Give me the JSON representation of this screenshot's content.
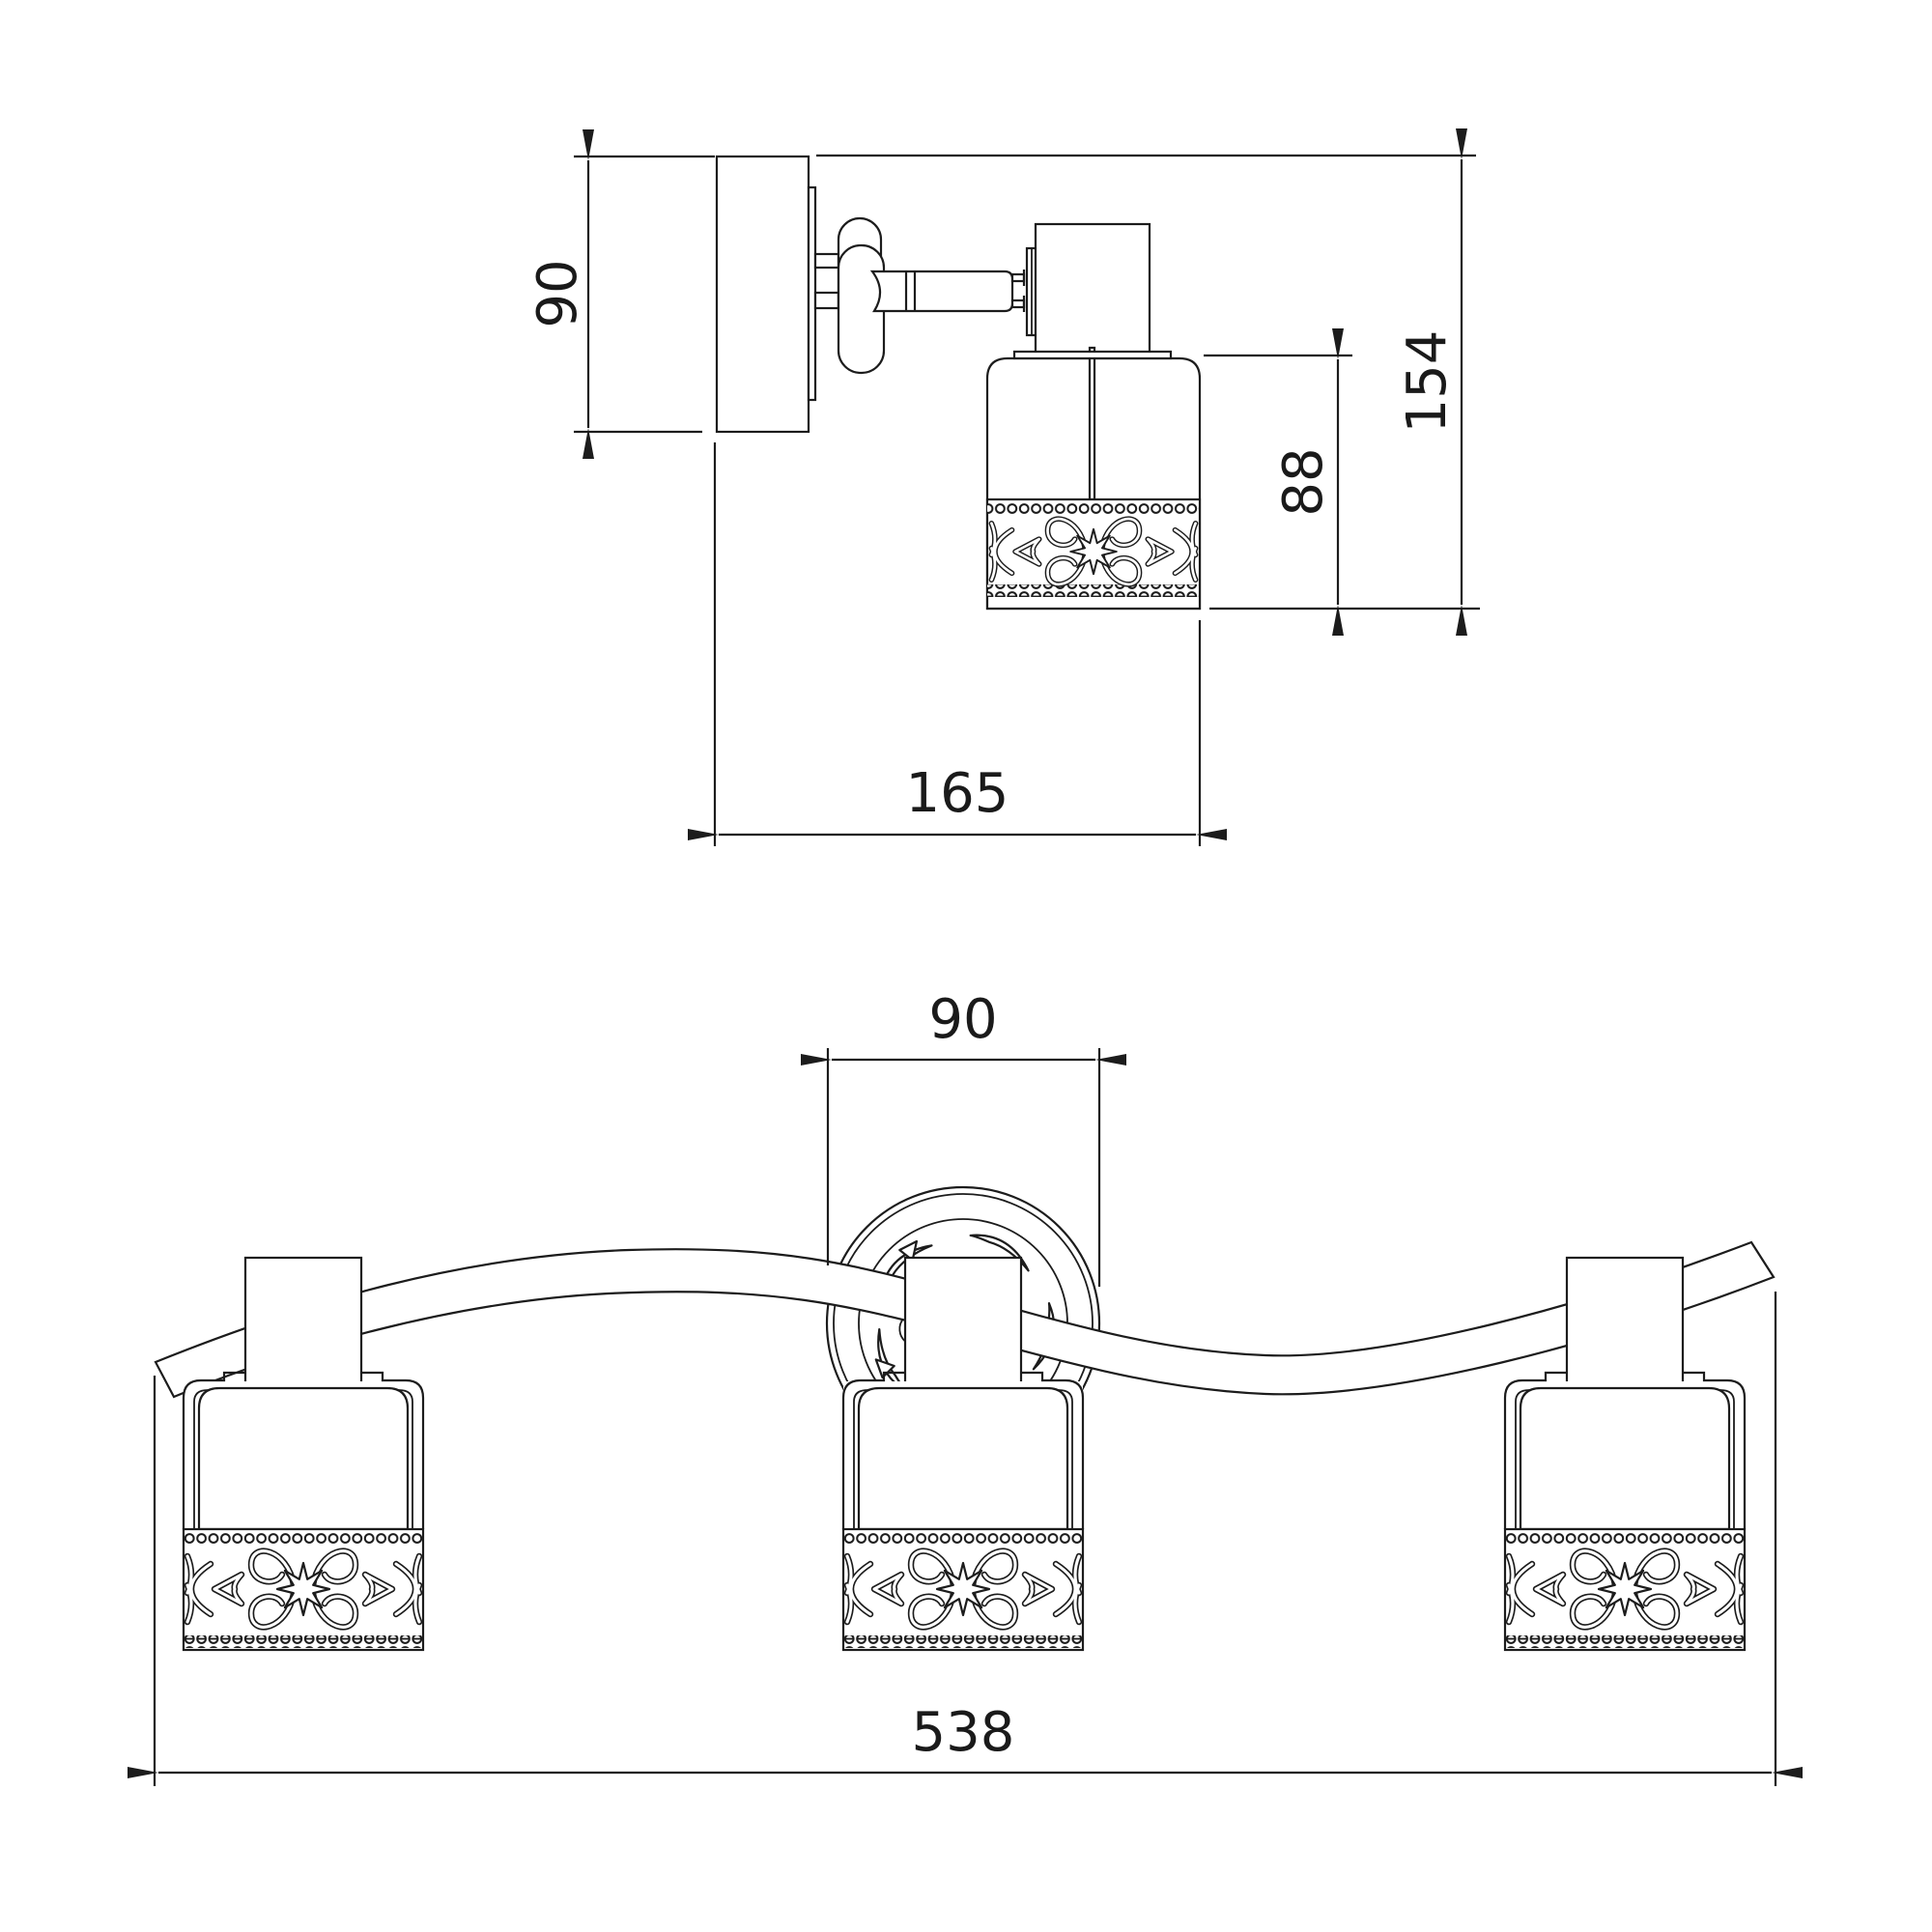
{
  "drawing": {
    "kind": "technical dimension line drawing, 2 views of a 3-spot light fixture",
    "background_color": "#ffffff",
    "line_color": "#1c1c1c",
    "views": {
      "side": {
        "dims": {
          "plate_height": "90",
          "overall_height": "154",
          "shade_height": "88",
          "overall_depth": "165"
        }
      },
      "front": {
        "dims": {
          "canopy_diameter": "90",
          "overall_width": "538"
        }
      }
    }
  }
}
